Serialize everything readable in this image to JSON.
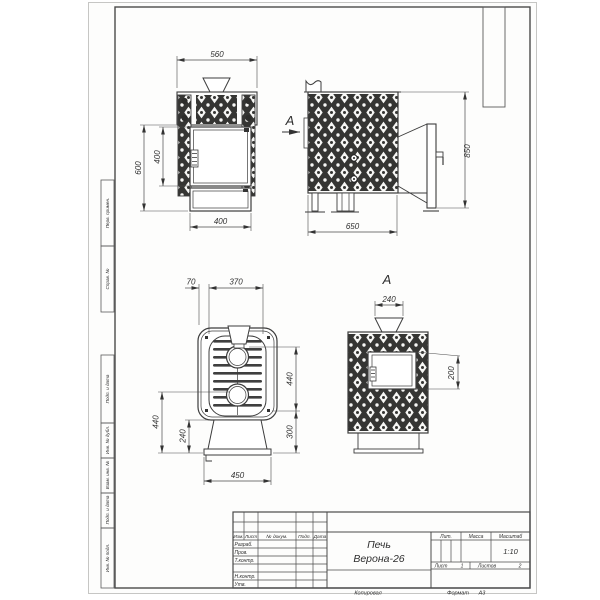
{
  "sheet": {
    "footer": {
      "copied": "Копировал",
      "format_label": "Формат",
      "format_value": "А3"
    },
    "margin_labels": {
      "perv": "Перв. примен.",
      "sprav": "Справ. №",
      "podp1": "Подп. и дата",
      "inv_dubl": "Инв. № дубл.",
      "vzam": "Взам. инв. №",
      "podp2": "Подп. и дата",
      "inv_podl": "Инв. № подл."
    }
  },
  "title_block": {
    "name_line1": "Печь",
    "name_line2": "Верона-26",
    "scale_value": "1:10",
    "cols": {
      "izm": "Изм.",
      "list": "Лист",
      "doc": "№ докум.",
      "podp": "Подп.",
      "data": "Дата"
    },
    "rows": {
      "razrab": "Разраб.",
      "prov": "Пров.",
      "tkontr": "Т.контр.",
      "nkontr": "Н.контр.",
      "utv": "Утв."
    },
    "right": {
      "lit": "Лит.",
      "massa": "Масса",
      "masshtab": "Масштаб",
      "list_label": "Лист",
      "list_value": "1",
      "listov_label": "Листов",
      "listov_value": "2"
    }
  },
  "views": {
    "front": {
      "dim_width_top": "560",
      "dim_height": "600",
      "dim_door_height": "400",
      "dim_width_bottom": "400"
    },
    "side": {
      "view_arrow_label": "А",
      "dim_height": "850",
      "dim_depth": "650"
    },
    "top": {
      "dim_flange": "70",
      "dim_inner_width": "370",
      "dim_right_upper": "440",
      "dim_right_lower": "300",
      "dim_left_total": "440",
      "dim_left_base": "240",
      "dim_base_width": "450"
    },
    "rear": {
      "view_label": "А",
      "dim_chimney": "240",
      "dim_window": "200"
    }
  }
}
